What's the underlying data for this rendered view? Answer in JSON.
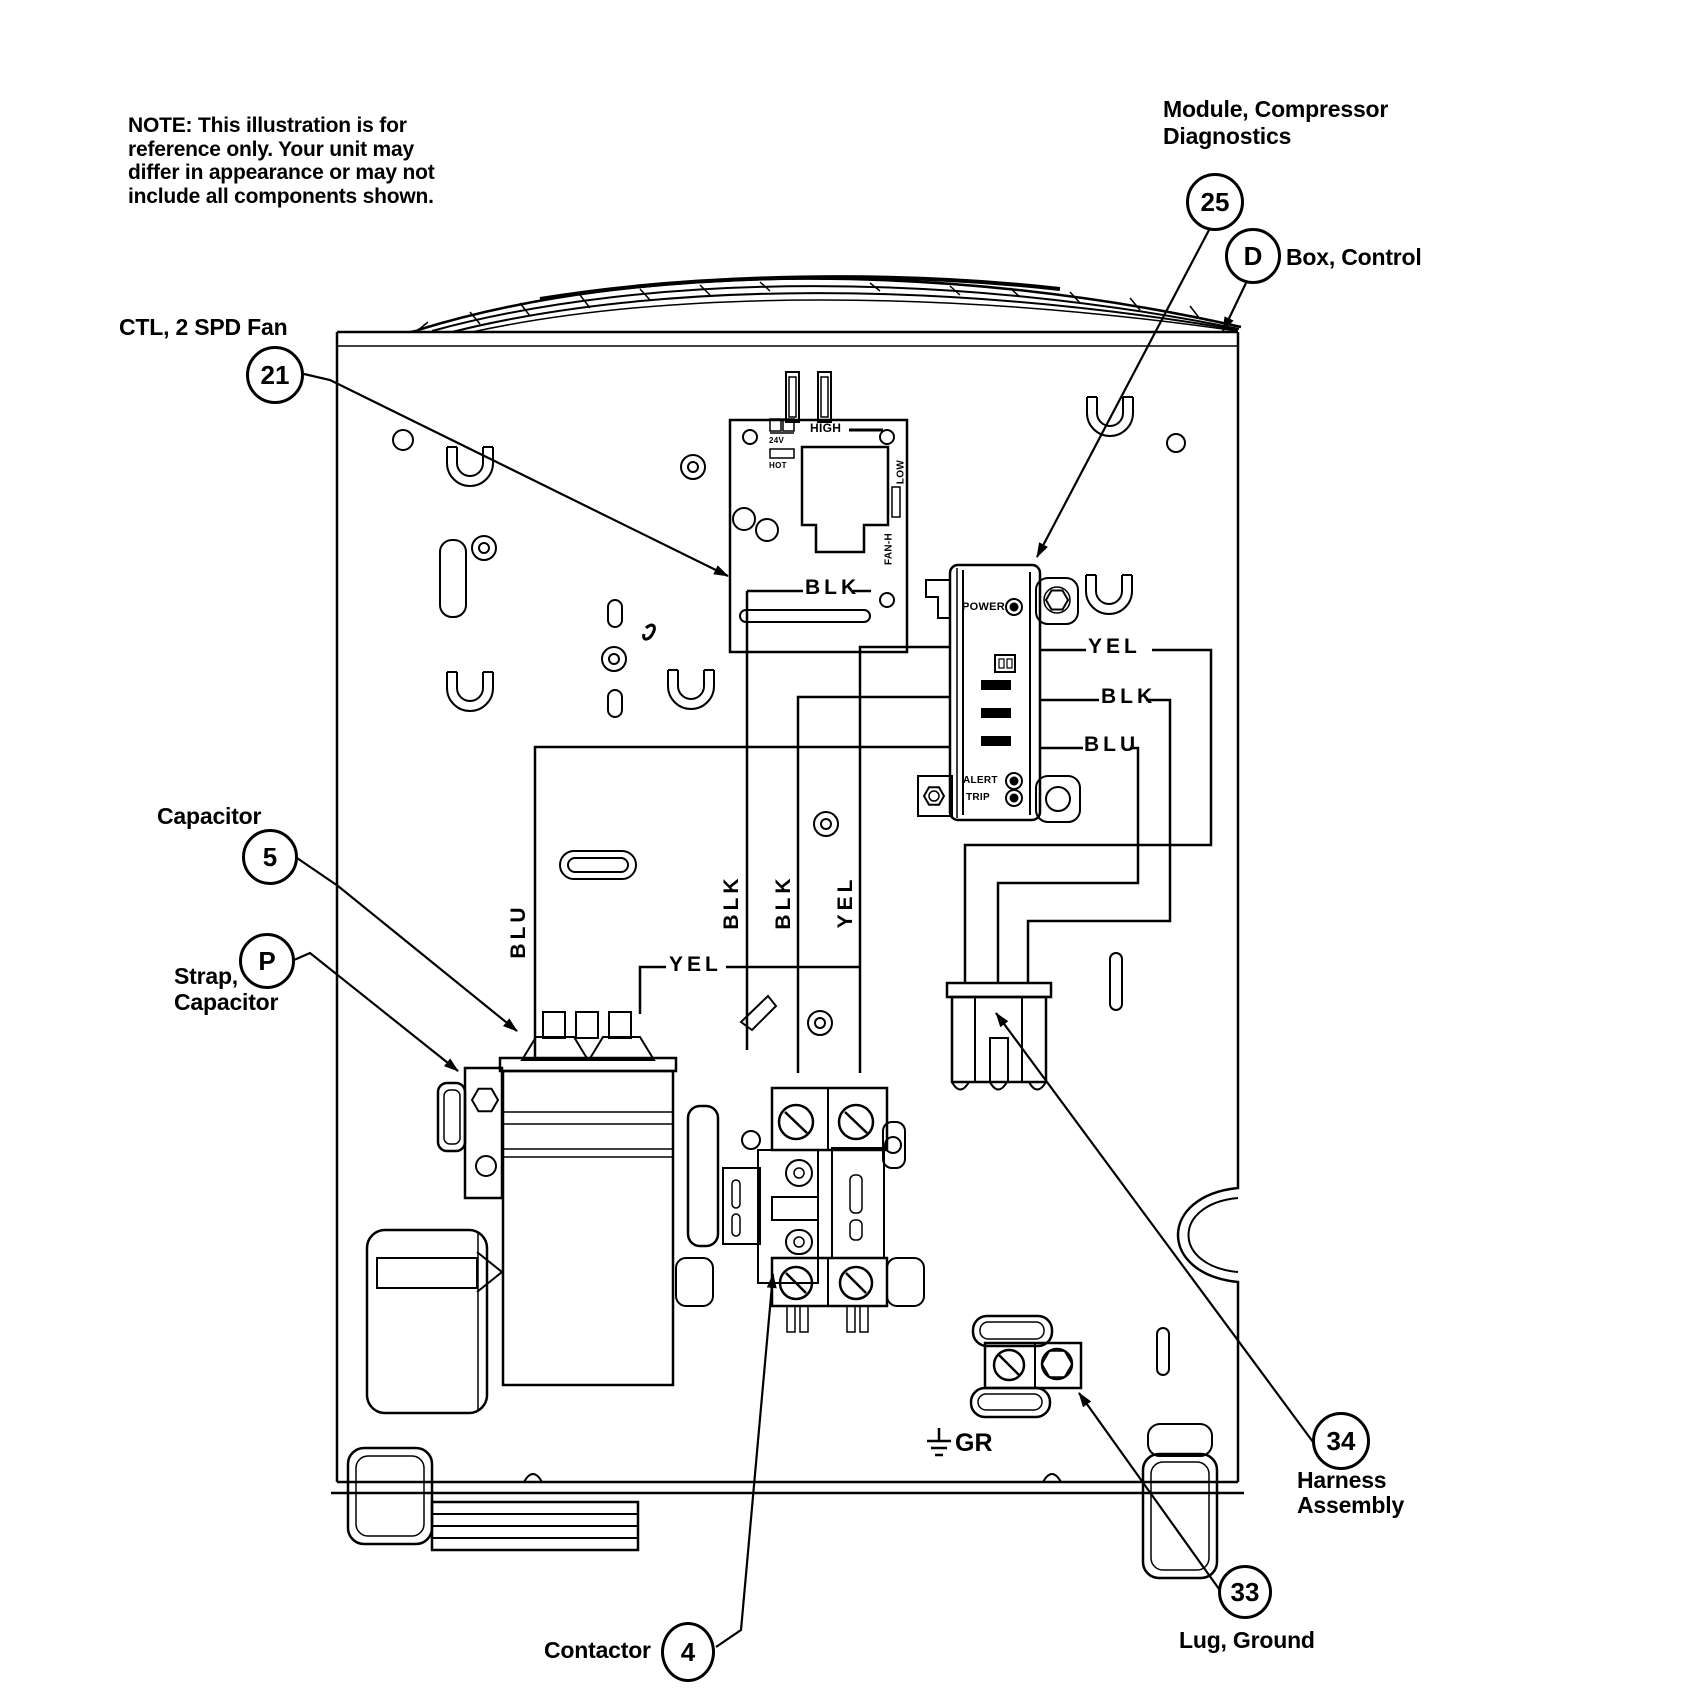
{
  "note": {
    "lines": [
      "NOTE: This illustration is for",
      "reference only. Your unit may",
      "differ in appearance or may not",
      "include all components shown."
    ]
  },
  "callouts": {
    "fan_control": {
      "number": "21",
      "label": "CTL, 2 SPD Fan"
    },
    "diagnostics_module": {
      "number": "25",
      "label_line1": "Module, Compressor",
      "label_line2": "Diagnostics"
    },
    "control_box": {
      "number": "D",
      "label": "Box, Control"
    },
    "capacitor": {
      "number": "5",
      "label": "Capacitor"
    },
    "capacitor_strap": {
      "number": "P",
      "label_line1": "Strap,",
      "label_line2": "Capacitor"
    },
    "contactor": {
      "number": "4",
      "label": "Contactor"
    },
    "harness_assembly": {
      "number": "34",
      "label_line1": "Harness",
      "label_line2": "Assembly"
    },
    "ground_lug": {
      "number": "33",
      "label": "Lug, Ground"
    }
  },
  "wire_labels": {
    "module_right_yel": "YEL",
    "module_right_blk": "BLK",
    "module_right_blu": "BLU",
    "board_blk": "BLK",
    "mid_yel": "YEL",
    "vert_blu": "BLU",
    "vert_blk_1": "BLK",
    "vert_blk_2": "BLK",
    "vert_yel": "YEL",
    "ground": "GR"
  },
  "module_labels": {
    "power": "POWER",
    "alert": "ALERT",
    "trip": "TRIP"
  },
  "board_labels": {
    "volts": "24V",
    "hot": "HOT",
    "high": "HIGH",
    "low": "LOW",
    "fan_h": "FAN-H"
  }
}
